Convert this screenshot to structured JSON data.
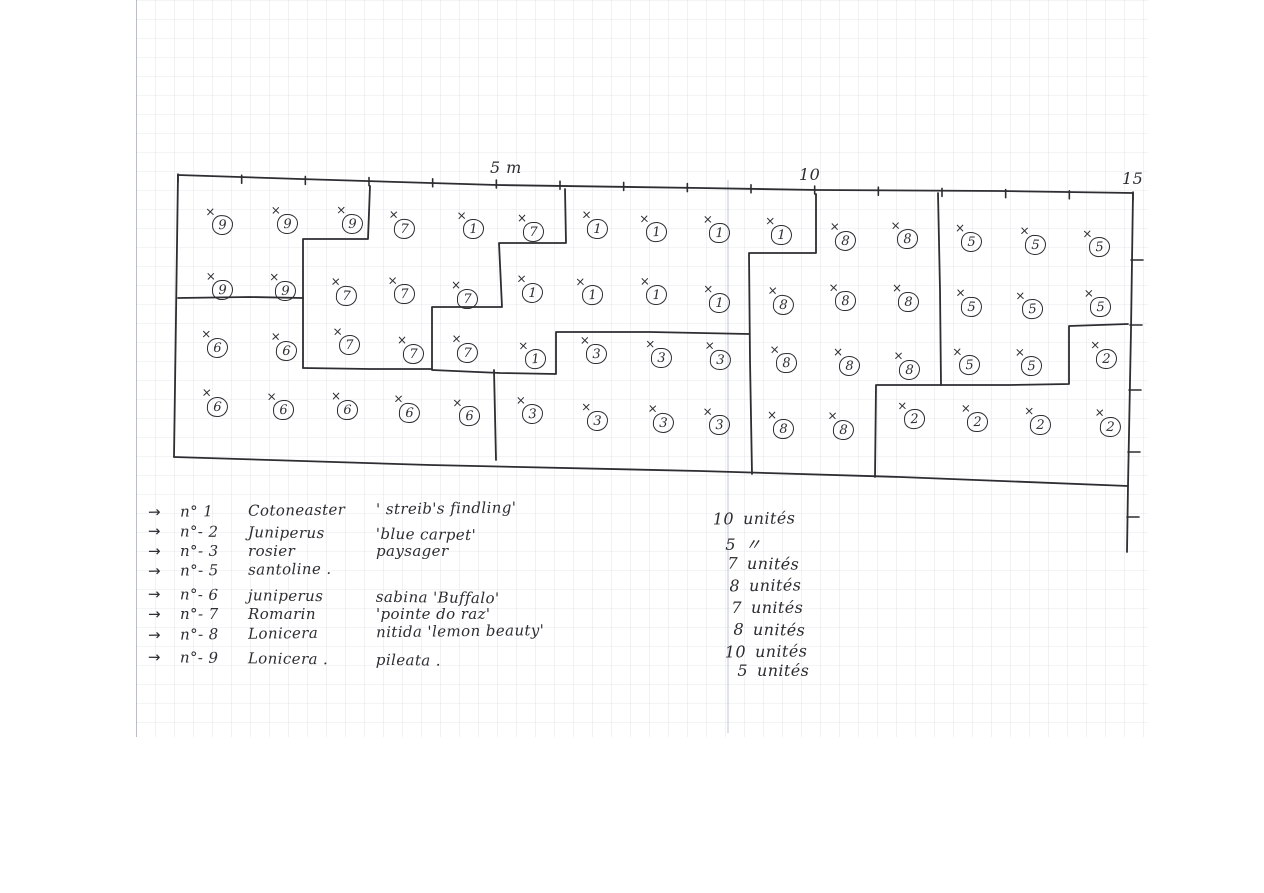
{
  "document": {
    "kind": "hand-drawn garden planting plan on graph paper"
  },
  "ink_color": "#2d2d32",
  "scale_labels": [
    {
      "id": "5m",
      "text": "5 m",
      "x": 490,
      "y": 158
    },
    {
      "id": "10m",
      "text": "10",
      "x": 799,
      "y": 165
    },
    {
      "id": "15m",
      "text": "15",
      "x": 1122,
      "y": 169
    }
  ],
  "plan": {
    "marker": "×",
    "plants": [
      {
        "x": 222,
        "y": 223,
        "n": "9"
      },
      {
        "x": 287,
        "y": 222,
        "n": "9"
      },
      {
        "x": 352,
        "y": 222,
        "n": "9"
      },
      {
        "x": 404,
        "y": 227,
        "n": "7"
      },
      {
        "x": 473,
        "y": 227,
        "n": "1"
      },
      {
        "x": 533,
        "y": 230,
        "n": "7"
      },
      {
        "x": 597,
        "y": 227,
        "n": "1"
      },
      {
        "x": 656,
        "y": 230,
        "n": "1"
      },
      {
        "x": 719,
        "y": 231,
        "n": "1"
      },
      {
        "x": 781,
        "y": 233,
        "n": "1"
      },
      {
        "x": 845,
        "y": 239,
        "n": "8"
      },
      {
        "x": 907,
        "y": 237,
        "n": "8"
      },
      {
        "x": 971,
        "y": 240,
        "n": "5"
      },
      {
        "x": 1035,
        "y": 243,
        "n": "5"
      },
      {
        "x": 1099,
        "y": 245,
        "n": "5"
      },
      {
        "x": 222,
        "y": 288,
        "n": "9"
      },
      {
        "x": 285,
        "y": 289,
        "n": "9"
      },
      {
        "x": 346,
        "y": 294,
        "n": "7"
      },
      {
        "x": 404,
        "y": 292,
        "n": "7"
      },
      {
        "x": 467,
        "y": 297,
        "n": "7"
      },
      {
        "x": 532,
        "y": 291,
        "n": "1"
      },
      {
        "x": 592,
        "y": 293,
        "n": "1"
      },
      {
        "x": 656,
        "y": 293,
        "n": "1"
      },
      {
        "x": 719,
        "y": 301,
        "n": "1"
      },
      {
        "x": 783,
        "y": 303,
        "n": "8"
      },
      {
        "x": 845,
        "y": 299,
        "n": "8"
      },
      {
        "x": 908,
        "y": 300,
        "n": "8"
      },
      {
        "x": 971,
        "y": 305,
        "n": "5"
      },
      {
        "x": 1032,
        "y": 307,
        "n": "5"
      },
      {
        "x": 1100,
        "y": 305,
        "n": "5"
      },
      {
        "x": 217,
        "y": 346,
        "n": "6"
      },
      {
        "x": 286,
        "y": 349,
        "n": "6"
      },
      {
        "x": 349,
        "y": 343,
        "n": "7"
      },
      {
        "x": 413,
        "y": 352,
        "n": "7"
      },
      {
        "x": 467,
        "y": 351,
        "n": "7"
      },
      {
        "x": 535,
        "y": 357,
        "n": "1"
      },
      {
        "x": 596,
        "y": 352,
        "n": "3"
      },
      {
        "x": 661,
        "y": 356,
        "n": "3"
      },
      {
        "x": 720,
        "y": 358,
        "n": "3"
      },
      {
        "x": 786,
        "y": 361,
        "n": "8"
      },
      {
        "x": 849,
        "y": 364,
        "n": "8"
      },
      {
        "x": 909,
        "y": 368,
        "n": "8"
      },
      {
        "x": 969,
        "y": 363,
        "n": "5"
      },
      {
        "x": 1031,
        "y": 364,
        "n": "5"
      },
      {
        "x": 1106,
        "y": 357,
        "n": "2"
      },
      {
        "x": 217,
        "y": 405,
        "n": "6"
      },
      {
        "x": 283,
        "y": 408,
        "n": "6"
      },
      {
        "x": 347,
        "y": 408,
        "n": "6"
      },
      {
        "x": 409,
        "y": 411,
        "n": "6"
      },
      {
        "x": 469,
        "y": 414,
        "n": "6"
      },
      {
        "x": 532,
        "y": 412,
        "n": "3"
      },
      {
        "x": 597,
        "y": 419,
        "n": "3"
      },
      {
        "x": 663,
        "y": 421,
        "n": "3"
      },
      {
        "x": 719,
        "y": 423,
        "n": "3"
      },
      {
        "x": 783,
        "y": 427,
        "n": "8"
      },
      {
        "x": 843,
        "y": 428,
        "n": "8"
      },
      {
        "x": 914,
        "y": 417,
        "n": "2"
      },
      {
        "x": 977,
        "y": 420,
        "n": "2"
      },
      {
        "x": 1040,
        "y": 423,
        "n": "2"
      },
      {
        "x": 1110,
        "y": 425,
        "n": "2"
      }
    ]
  },
  "legend": {
    "arrow": "→",
    "items": [
      {
        "num": "n° 1",
        "name": "Cotoneaster",
        "detail": "' streib's findling'",
        "y": 503
      },
      {
        "num": "n°- 2",
        "name": "Juniperus",
        "detail": "'blue carpet'",
        "y": 522
      },
      {
        "num": "n°- 3",
        "name": "rosier",
        "detail": "paysager",
        "y": 542
      },
      {
        "num": "n°- 5",
        "name": "santoline .",
        "detail": "",
        "y": 562
      },
      {
        "num": "n°- 6",
        "name": "juniperus",
        "detail": "sabina 'Buffalo'",
        "y": 585
      },
      {
        "num": "n°- 7",
        "name": "Romarin",
        "detail": "'pointe do raz'",
        "y": 605
      },
      {
        "num": "n°- 8",
        "name": "Lonicera",
        "detail": "nitida 'lemon beauty'",
        "y": 626
      },
      {
        "num": "n°- 9",
        "name": "Lonicera .",
        "detail": "pileata .",
        "y": 648
      }
    ]
  },
  "quantities": [
    {
      "qty": "10",
      "unit": "unités",
      "y": 509
    },
    {
      "qty": "5",
      "unit": "〃",
      "y": 531
    },
    {
      "qty": "7",
      "unit": "unités",
      "y": 554
    },
    {
      "qty": "8",
      "unit": "unités",
      "y": 576
    },
    {
      "qty": "7",
      "unit": "unités",
      "y": 598
    },
    {
      "qty": "8",
      "unit": "unités",
      "y": 620
    },
    {
      "qty": "10",
      "unit": "unités",
      "y": 642
    },
    {
      "qty": "5",
      "unit": "unités",
      "y": 661
    }
  ]
}
